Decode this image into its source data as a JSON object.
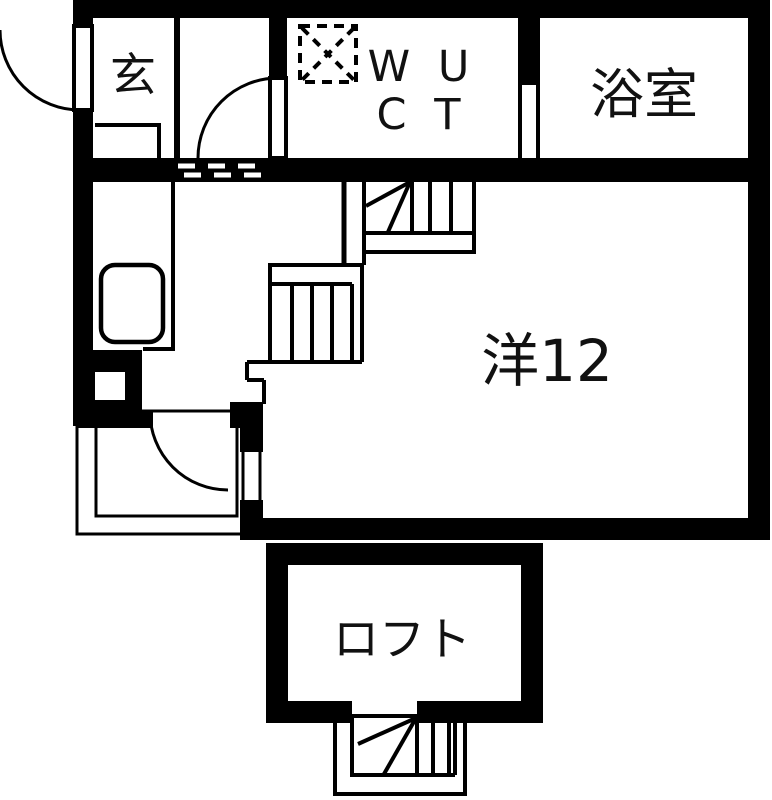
{
  "page": {
    "type": "apartment-floor-plan"
  },
  "colors": {
    "wall": "#000000",
    "floor": "#ffffff",
    "label": "#111111"
  },
  "labels": {
    "entrance": "玄",
    "wc_line1": "W U",
    "wc_line2": "C T",
    "bathroom": "浴室",
    "main_room": "洋12",
    "loft": "ロフト"
  }
}
